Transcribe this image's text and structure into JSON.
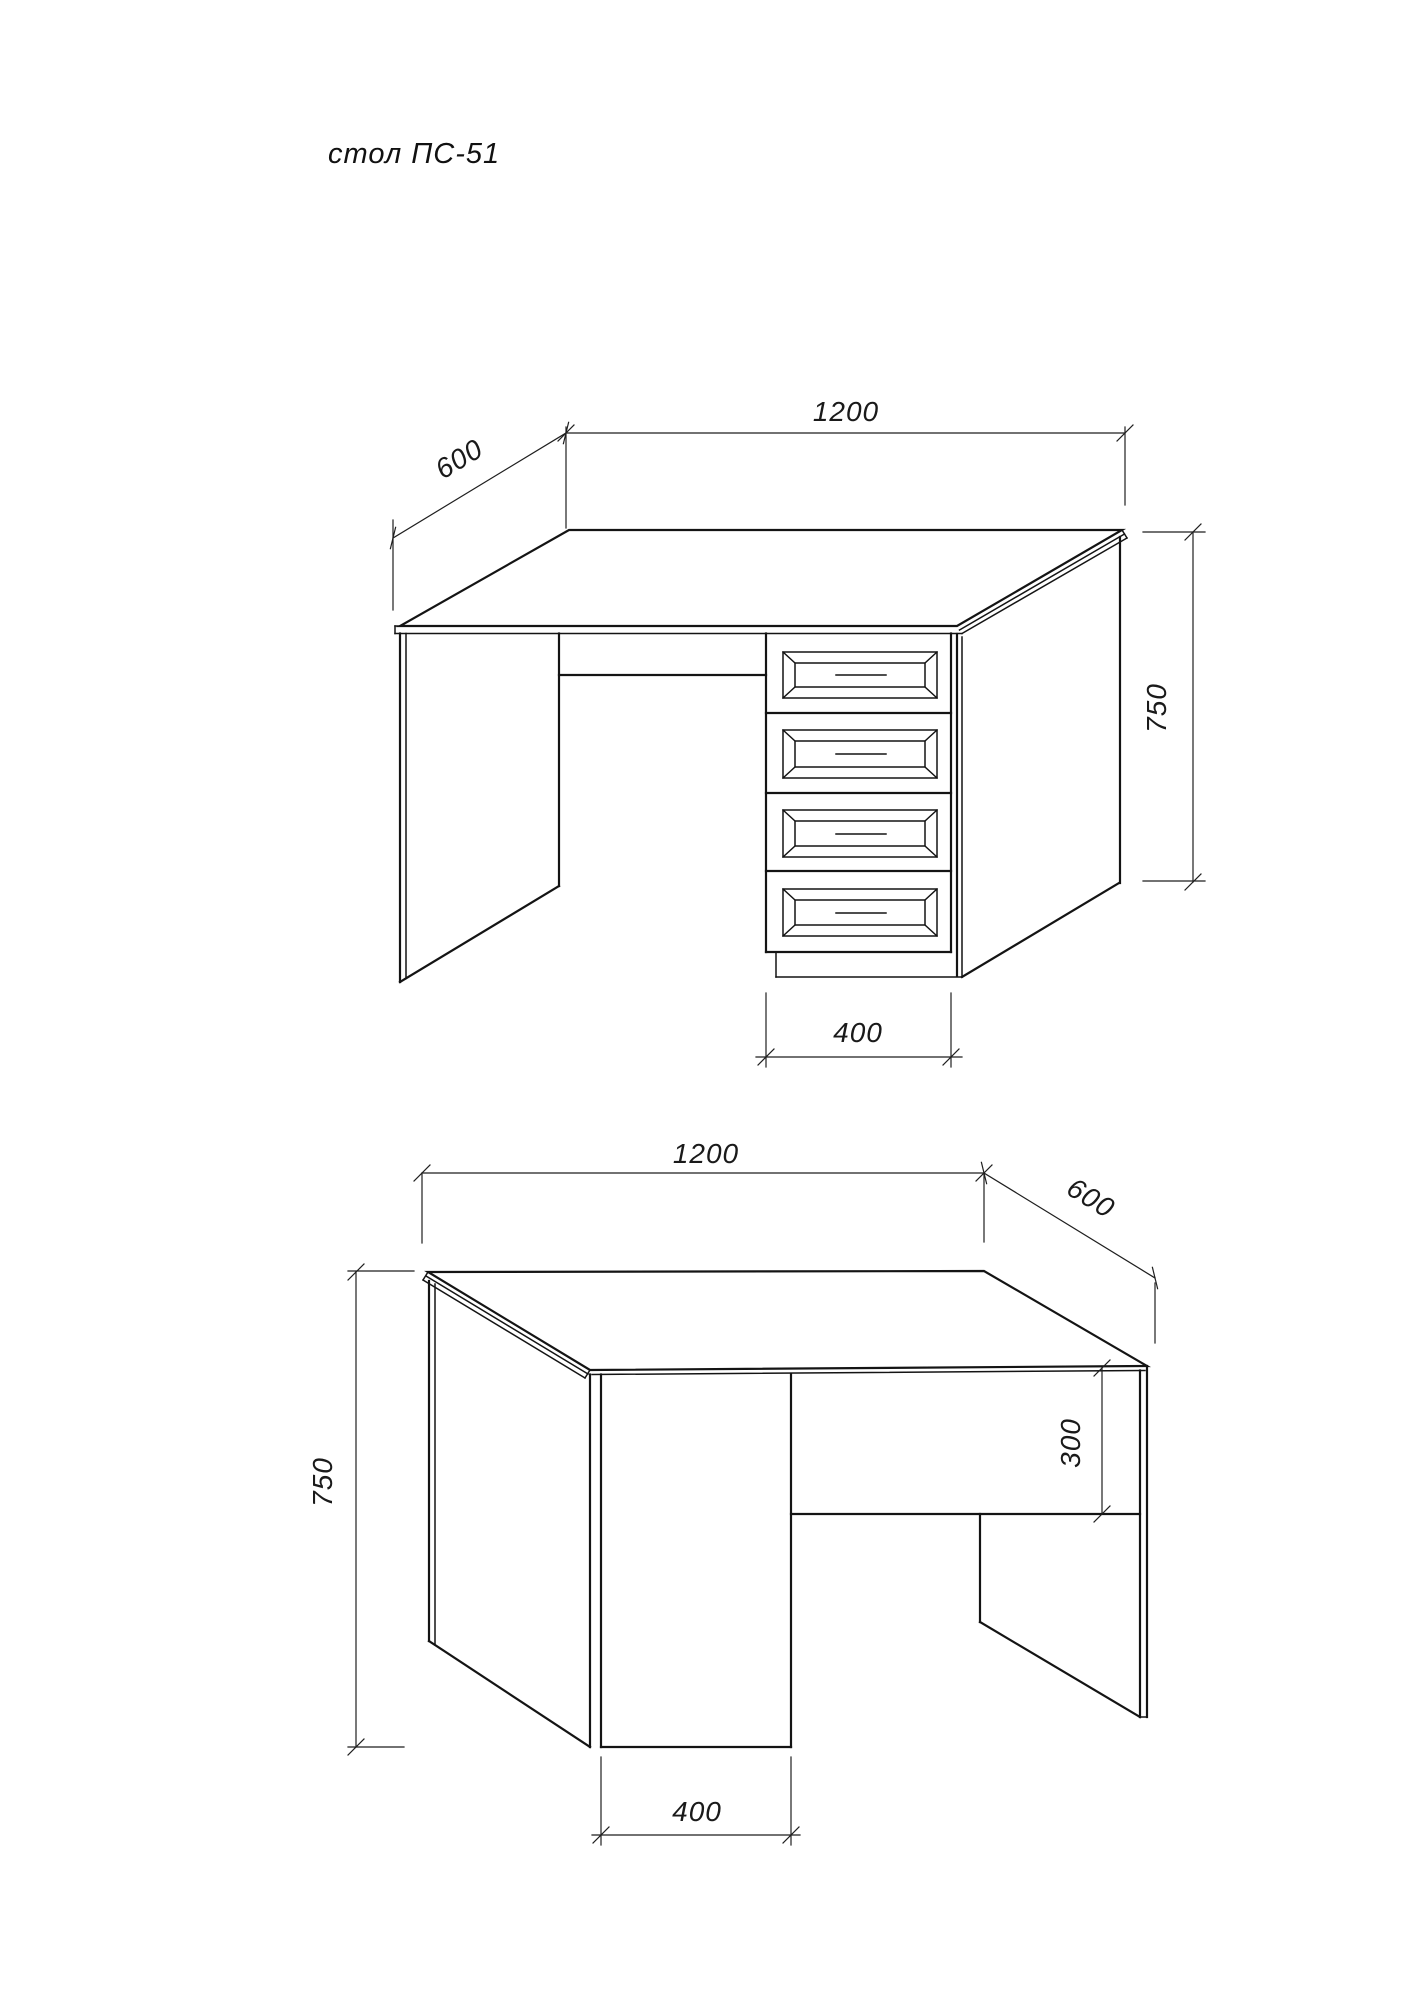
{
  "title": "стол ПС-51",
  "front_view": {
    "dim_width": "1200",
    "dim_depth": "600",
    "dim_height": "750",
    "dim_pedestal_width": "400"
  },
  "rear_view": {
    "dim_width": "1200",
    "dim_depth": "600",
    "dim_height": "750",
    "dim_back_panel_height": "300",
    "dim_pedestal_width": "400"
  },
  "colors": {
    "line": "#141414",
    "dimension_line": "#1f1f1f",
    "background": "#ffffff"
  }
}
